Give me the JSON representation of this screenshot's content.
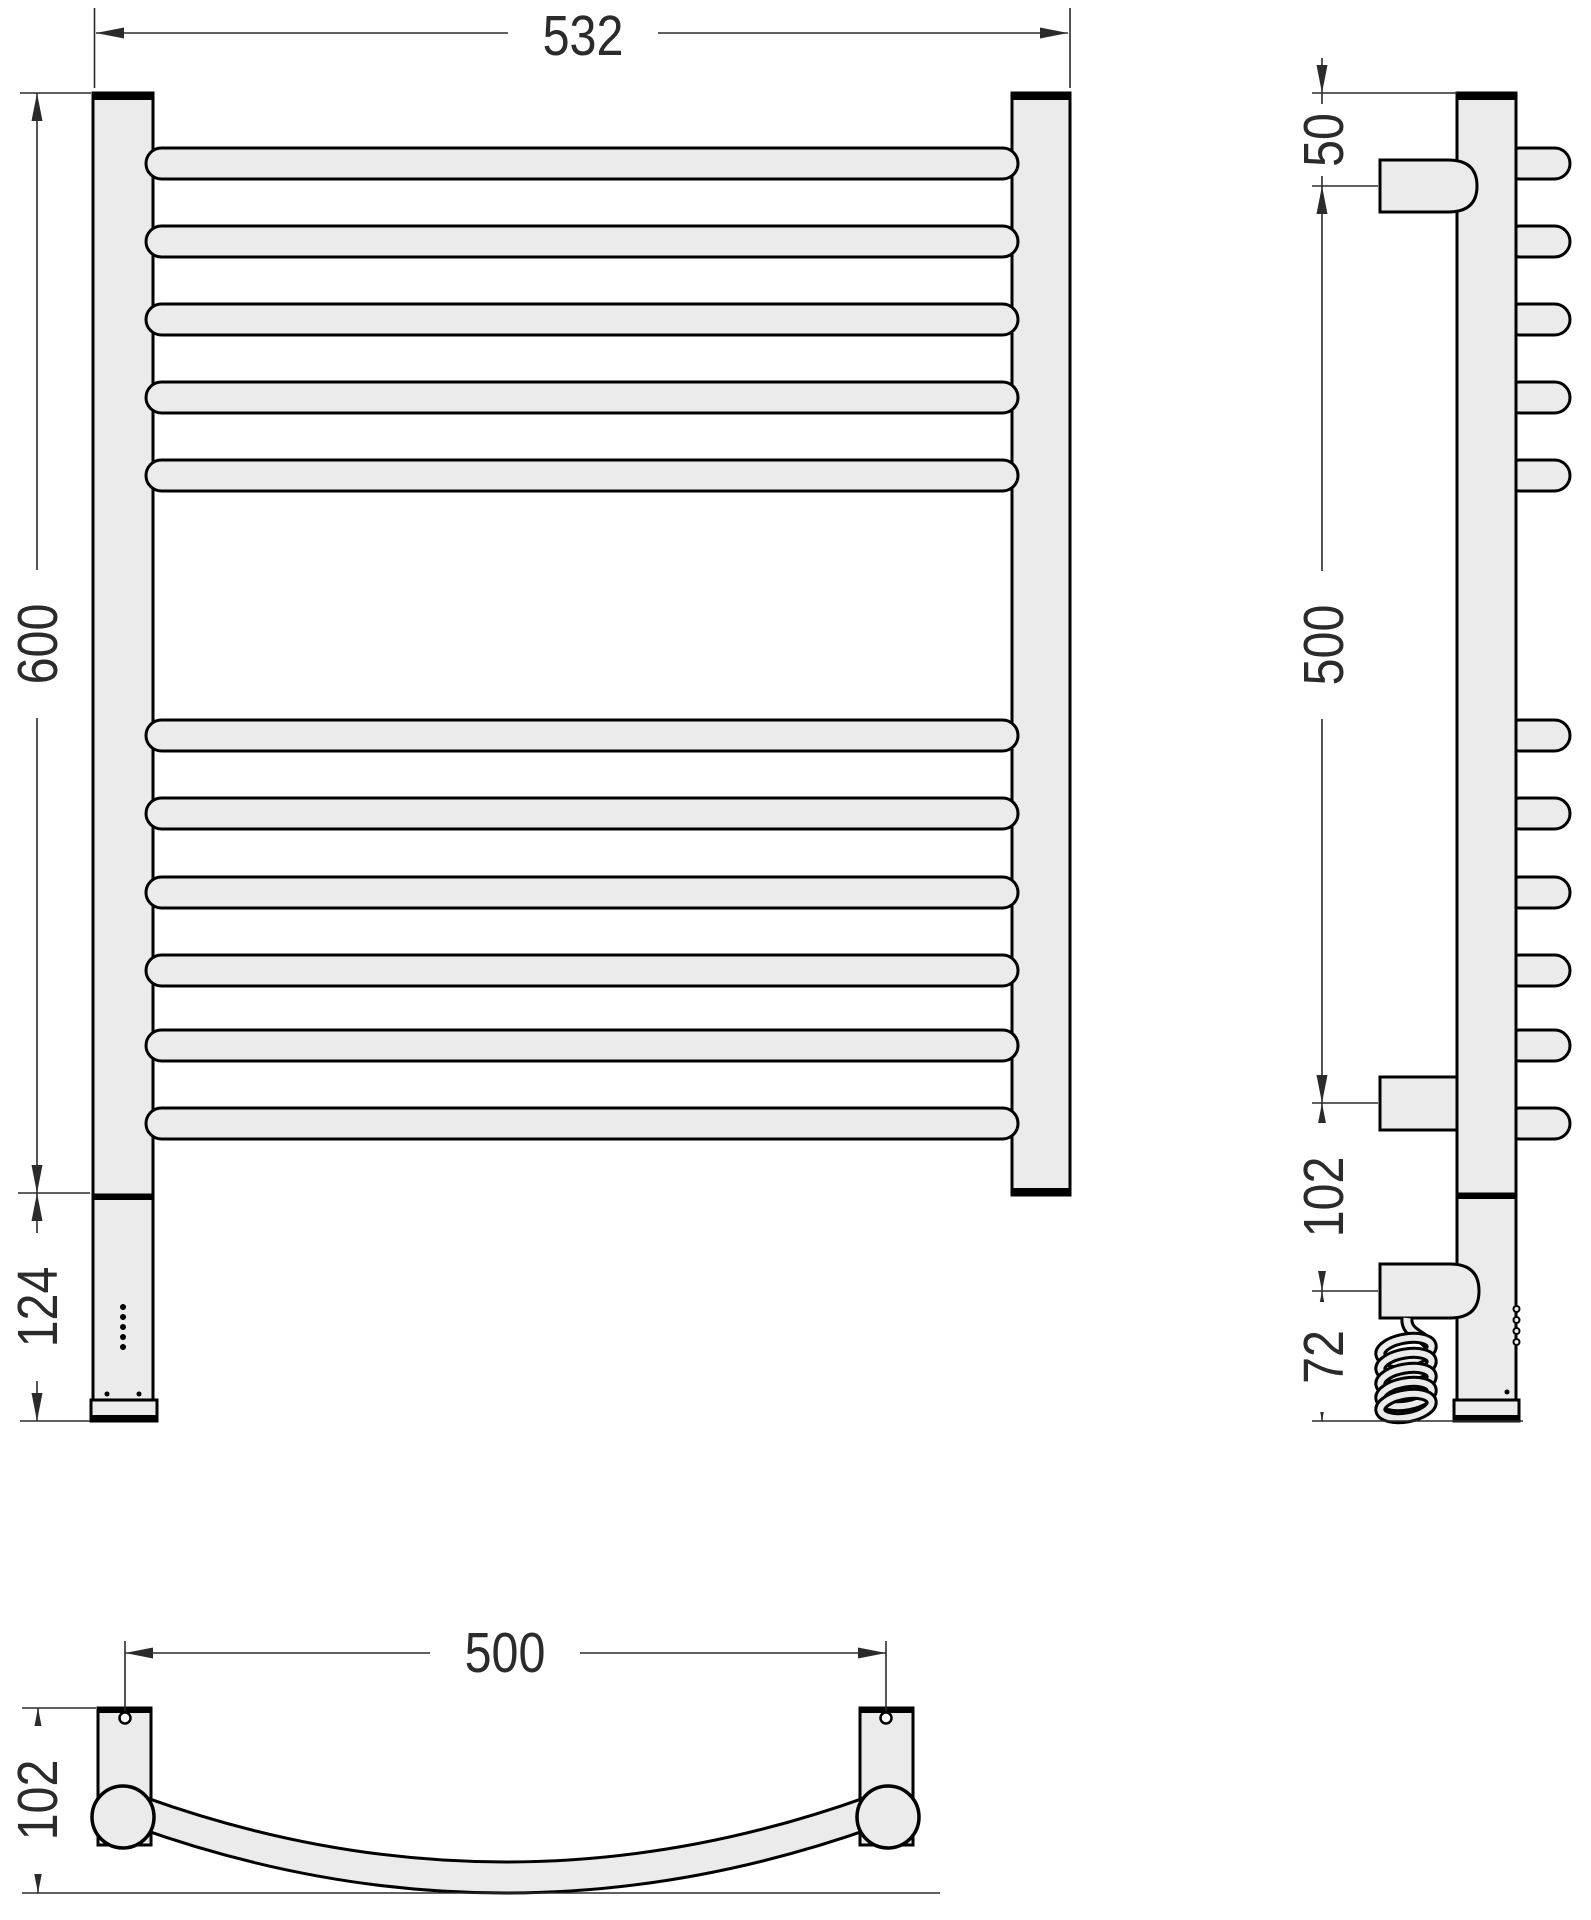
{
  "front": {
    "width": "532",
    "height": "600",
    "lower_section": "124"
  },
  "side": {
    "top_offset": "50",
    "bracket_span": "500",
    "bracket_to_heater": "102",
    "heater_to_base": "72"
  },
  "bottom": {
    "mount_spacing": "500",
    "depth": "102"
  },
  "colors": {
    "fill": "#ebebeb",
    "outline": "#000000",
    "dimension": "#2b2b2b",
    "background": "#ffffff"
  }
}
